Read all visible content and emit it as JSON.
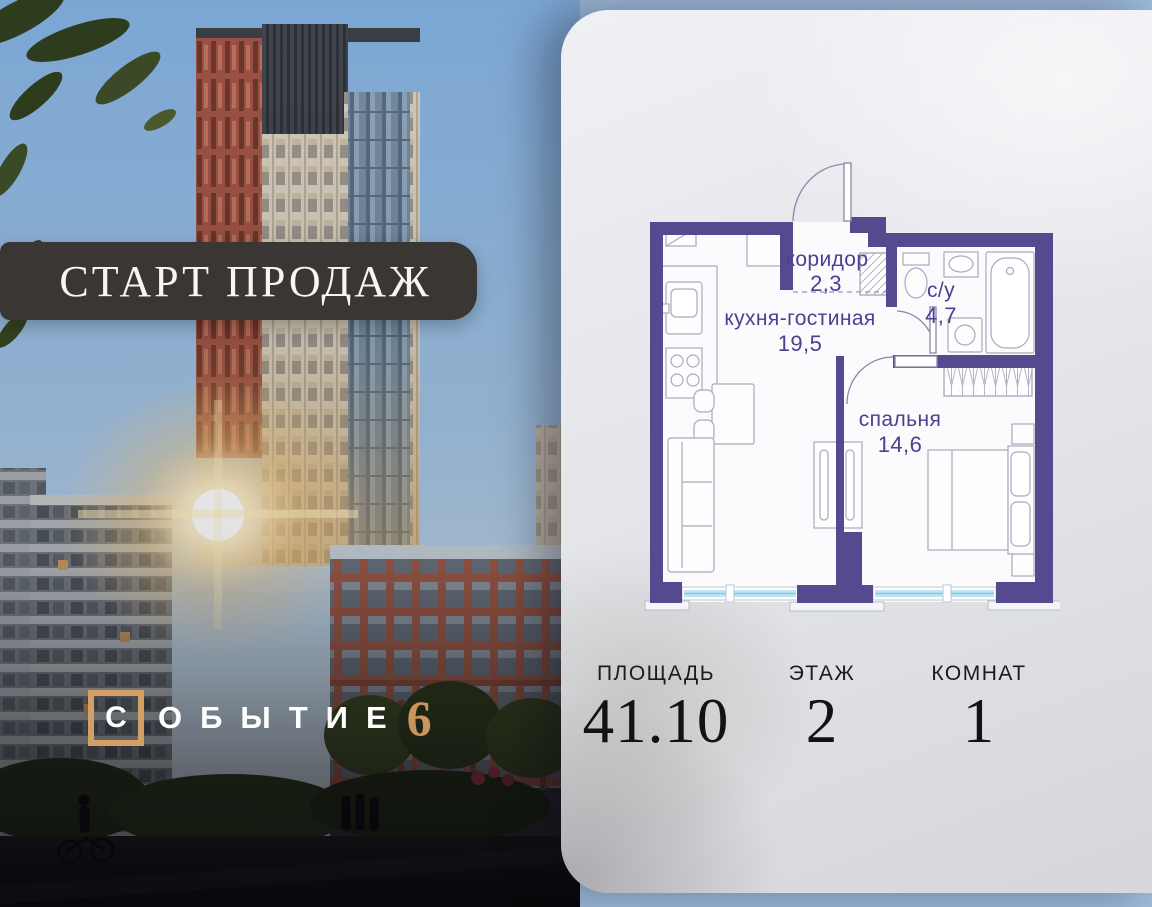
{
  "badge": {
    "label": "СТАРТ ПРОДАЖ"
  },
  "logo": {
    "boxed_letter": "С",
    "letters": "ОБЫТИЕ",
    "number": "6",
    "accent_color": "#d2a065"
  },
  "floor_plan": {
    "wall_color": "#554a90",
    "label_color": "#4a4190",
    "window_color": "#bfe4f4",
    "rooms": [
      {
        "name": "коридор",
        "area": "2,3"
      },
      {
        "name": "кухня-гостиная",
        "area": "19,5"
      },
      {
        "name": "с/у",
        "area": "4,7"
      },
      {
        "name": "спальня",
        "area": "14,6"
      }
    ]
  },
  "stats": [
    {
      "label": "ПЛОЩАДЬ",
      "value": "41.10"
    },
    {
      "label": "ЭТАЖ",
      "value": "2"
    },
    {
      "label": "КОМНАТ",
      "value": "1"
    }
  ]
}
